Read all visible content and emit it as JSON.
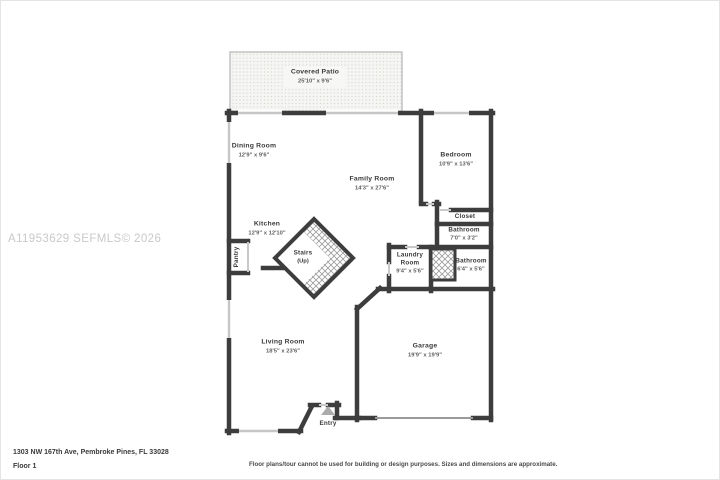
{
  "watermark": "A11953629 SEFMLS© 2026",
  "rooms": [
    {
      "id": "covered-patio",
      "name": "Covered Patio",
      "dims": "25'10\" x 9'6\""
    },
    {
      "id": "dining-room",
      "name": "Dining Room",
      "dims": "12'9\" x 9'6\""
    },
    {
      "id": "family-room",
      "name": "Family Room",
      "dims": "14'3\" x 27'6\""
    },
    {
      "id": "bedroom",
      "name": "Bedroom",
      "dims": "10'9\" x 13'6\""
    },
    {
      "id": "closet",
      "name": "Closet",
      "dims": ""
    },
    {
      "id": "bathroom-upper",
      "name": "Bathroom",
      "dims": "7'0\" x 3'2\""
    },
    {
      "id": "bathroom-lower",
      "name": "Bathroom",
      "dims": "6'4\" x 5'6\""
    },
    {
      "id": "laundry-room",
      "name": "Laundry Room",
      "dims": "9'4\" x 5'6\""
    },
    {
      "id": "kitchen",
      "name": "Kitchen",
      "dims": "12'9\" x 12'10\""
    },
    {
      "id": "pantry",
      "name": "Pantry",
      "dims": ""
    },
    {
      "id": "stairs",
      "name": "Stairs",
      "dims": "(Up)"
    },
    {
      "id": "living-room",
      "name": "Living Room",
      "dims": "18'5\" x 23'6\""
    },
    {
      "id": "garage",
      "name": "Garage",
      "dims": "19'9\" x 19'9\""
    },
    {
      "id": "entry",
      "name": "Entry",
      "dims": ""
    }
  ],
  "footer": {
    "address": "1303 NW 167th Ave, Pembroke Pines, FL 33028",
    "floor_label": "Floor 1",
    "disclaimer": "Floor plans/tour cannot be used for building or design purposes. Sizes and dimensions are approximate."
  },
  "colors": {
    "wall": "#3d3d3d",
    "window": "#c6c6c6",
    "hatch": "#9b9b9b",
    "patio_dot": "#d6d6d2",
    "watermark": "#c9c9c9",
    "room_text": "#3a3a3a",
    "dim_text": "#5f5f5f"
  }
}
